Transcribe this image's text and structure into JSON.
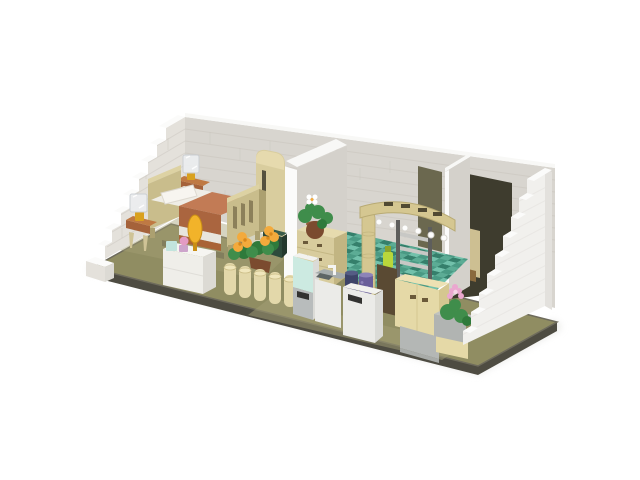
{
  "image": {
    "alt": "3D render of a LEGO-style apartment interior module: a bedroom with bed, lamps, dresser and yellow flowers on the left, a teal-tiled bathroom with archway and shelf in the middle, and a kitchen with fridge, sink and cabinets on the right, enclosed by white stepped brick walls on an olive baseplate",
    "background": "#ffffff"
  },
  "colors": {
    "background": "#ffffff",
    "shadow": "#e3e3e0",
    "base_side": "#4e4c42",
    "base_edge_top": "#6e6b5c",
    "floor_olive": "#908d62",
    "floor_olive_light": "#a49f75",
    "wall_back": "#d8d5cf",
    "wall_left": "#e4e1db",
    "wall_partition": "#d4d1cb",
    "wall_right": "#f1f0ed",
    "wall_right_side": "#e3e1dd",
    "wall_top_white": "#f8f8f6",
    "step_white": "#fbfbfa",
    "mortar": "#c7c3bc",
    "mortar_light": "#e5e3df",
    "closet_dark": "#3e3c2e",
    "doorway_dark": "#6b684f",
    "heater_tan": "#cdbf92",
    "heater_knob": "#8a6a3e",
    "bed_frame": "#c9bd8c",
    "bed_frame_dark": "#aca070",
    "bed_frame_top": "#ddd2a3",
    "slat_dark": "#8c805a",
    "pillow": "#f7f5f0",
    "sheet": "#efede6",
    "mattress_side": "#e8e5dd",
    "blanket": "#c27b55",
    "blanket_dark": "#aa653f",
    "boxspring": "#a96336",
    "under_bed": "#6b684f",
    "nightstand_top": "#bf7943",
    "nightstand_front": "#a5623a",
    "leg_tan": "#cfc396",
    "lamp_gold": "#d9a11f",
    "lamp_shade": "#eceef0",
    "lamp_shade_line": "#c9ced3",
    "dresser_top": "#f6f5f1",
    "dresser_front": "#efeee9",
    "dresser_side": "#dcdad4",
    "trinket_mint": "#c2e4dd",
    "trinket_pink": "#e39bc3",
    "trinket_pink_base": "#cda4cb",
    "plume_gold": "#f2b32a",
    "plume_gold_dark": "#c98e15",
    "planter_tan": "#e3d8aa",
    "planter_tan_dark": "#ccbe88",
    "planter_tan_top": "#f0e6bc",
    "pot_brown": "#7b4b2f",
    "pot_brown_light": "#935d39",
    "leaf_green": "#3f8d4b",
    "leaf_green_dark": "#2f7a3b",
    "flower_yellow": "#f3aa3c",
    "flower_yellow_dark": "#d8881c",
    "flower_white": "#ffffff",
    "wardrobe_tan": "#d9cd9e",
    "wardrobe_tan_top": "#e8dcb0",
    "wardrobe_slot": "#55513e",
    "wardrobe_green": "#2e4a3c",
    "wardrobe_green_dark": "#24392e",
    "wardrobe_green_top": "#3a5c4a",
    "chest_tan": "#d8cc9d",
    "chest_tan_side": "#c2b582",
    "chest_tan_top": "#e6dbae",
    "chest_handle": "#6b5a3a",
    "tile_a": "#4a9a84",
    "tile_b": "#72c1ab",
    "tile_c": "#357f6b",
    "tile_d": "#5cac95",
    "arch_tan": "#d5c791",
    "arch_tan_dark": "#b8aa73",
    "arch_slot": "#514a33",
    "stud_white": "#fdfdfc",
    "stud_stroke": "#d8d6d0",
    "shelf_frame": "#5e5e5c",
    "shelf_board": "#c8c8c5",
    "gap_brown": "#5a4a33",
    "spray_lime": "#b9d73b",
    "spray_lime_dark": "#8ba32b",
    "fridge_mint": "#cceae1",
    "fridge_gray": "#b8bcbc",
    "appliance_white": "#ebebe8",
    "appliance_side": "#dbdbd7",
    "appliance_top": "#f2f2ef",
    "handle_dark": "#333331",
    "counter_steel": "#a6acac",
    "basin_dark": "#5e6565",
    "faucet_white": "#f4f4f2",
    "canister_navy": "#3e4468",
    "canister_navy_top": "#555c84",
    "canister_purple": "#6a5f9a",
    "canister_purple_light": "#8d83b8",
    "cabinet_tan": "#e5d9a7",
    "cabinet_tan_side": "#d5c790",
    "cabinet_tan_top": "#ede1b3",
    "counter_gray": "#bfc2c0",
    "counter_gray_front": "#b1b4b2",
    "base_gray_block": "#b4b7b5",
    "base_gray_block_dark": "#a8aba8",
    "flower_pink": "#eaa7cf",
    "flower_pink_center": "#f6d6e7"
  }
}
